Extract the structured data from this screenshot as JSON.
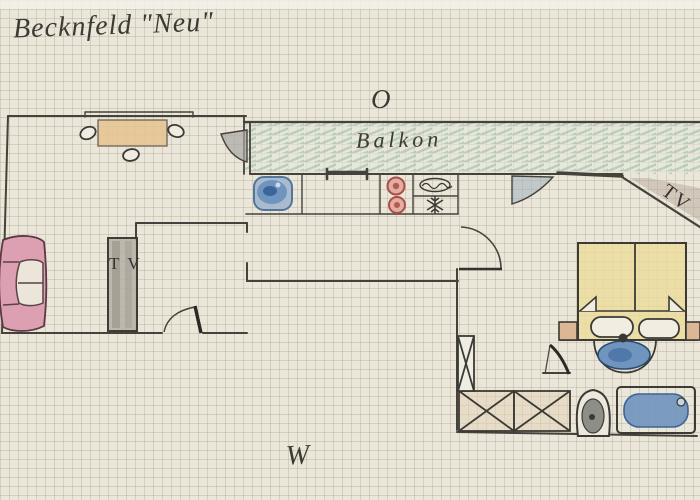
{
  "title": "Becknfeld \"Neu\"",
  "compass": {
    "top": "O",
    "bottom": "W"
  },
  "balcony": {
    "label": "Balkon"
  },
  "living_room": {
    "tv_cabinet_label": "TV"
  },
  "bedroom": {
    "corner_tv_label": "TV"
  },
  "colors": {
    "paper": "#eae6da",
    "grid": "#cfc6b4",
    "pencil": "#45423c",
    "balcony_green": "#8fb49c",
    "balcony_base": "#e3e8dc",
    "table_tan": "#e5c493",
    "sofa_pink": "#dd9fb2",
    "bed_yellow": "#ecdc9a",
    "nightstand_tan": "#dcb795",
    "water_blue": "#6f94bd",
    "water_deep": "#3c659c",
    "wood_light": "#e3d1b6",
    "door_gray": "#a6a6a2",
    "shade_gray": "#b3a294"
  }
}
